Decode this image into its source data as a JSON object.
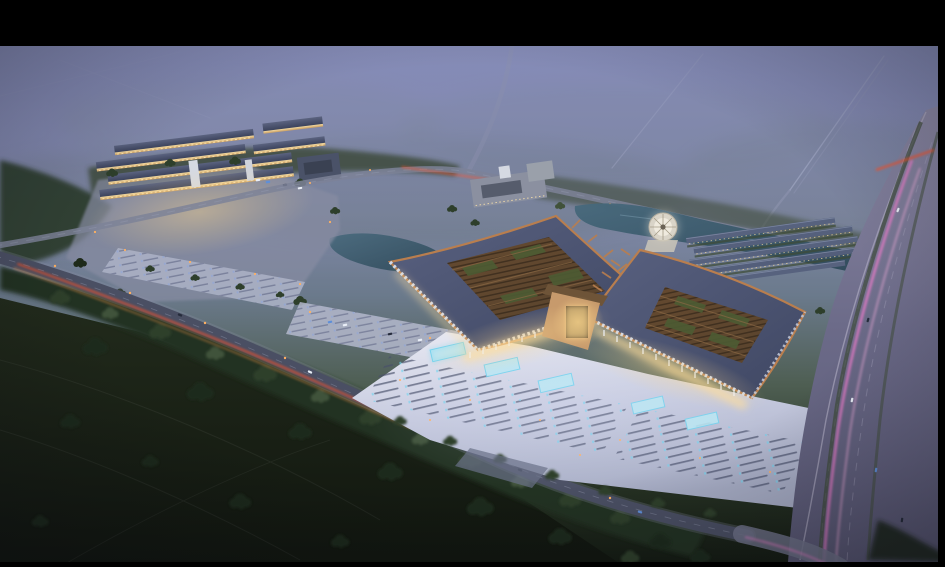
{
  "image": {
    "type": "architectural-aerial-rendering",
    "title": "Aerial dusk rendering of a traditional-style market and exhibition complex",
    "description": "Photorealistic bird's-eye 3D rendering at dusk: two large Chinese-style halls with upswept copper-edged roofs and open lattice courtyards front a brightly lit plaza with cyan reflecting pools and stall rows; a secondary warehouse market complex sits to the west; a pond with a circular fountain plaza and rows of dormitory buildings lie to the north-east; a multi-lane highway with pink light trails runs along the right edge; a diagonal road with red tail-light trails crosses dark fields and forest in the foreground; the frame is letterboxed with black bars.",
    "time_of_day": "dusk",
    "letterbox": "black bars: top, thin right and bottom edges"
  },
  "scene": {
    "features": [
      {
        "name": "sky-haze",
        "label": "lavender dusk haze over distant fields"
      },
      {
        "name": "far-roads",
        "label": "hazy diagonal country roads, top right"
      },
      {
        "name": "forest-bands",
        "label": "dark tree belts along roads and site edges"
      },
      {
        "name": "dark-field",
        "label": "unlit farmland, bottom left"
      },
      {
        "name": "left-complex",
        "label": "western market complex with lit warehouse rows and parking"
      },
      {
        "name": "main-complex",
        "label": "two grand halls with lattice courtyard roofs and central gate"
      },
      {
        "name": "plaza",
        "label": "illuminated forecourt with pools, stalls and lamps"
      },
      {
        "name": "pond",
        "label": "canal pond behind the halls"
      },
      {
        "name": "fountain-plaza",
        "label": "round white fountain terrace"
      },
      {
        "name": "dorm-rows",
        "label": "parallel rows of small buildings, north-east"
      },
      {
        "name": "highway",
        "label": "wide highway with pink light trails, right edge"
      },
      {
        "name": "front-road",
        "label": "diagonal arterial road with red tail-light trails"
      },
      {
        "name": "letterbox-bars",
        "label": "black letterbox frame"
      }
    ]
  },
  "colors": {
    "frame": "#000000",
    "sky_top": "#6d76b2",
    "sky_mid": "#7d84ae",
    "haze": "#8a90b8",
    "ground_far": "#66775f",
    "field": "#10150e",
    "forest": "#243020",
    "tree_dark": "#1e2a1a",
    "tree_mid": "#2e3f2b",
    "tree_lit": "#41523a",
    "road_far": "#a9aec4",
    "road_mid": "#7d8398",
    "road_dark": "#4a4f63",
    "trail_red": "#ff5226",
    "trail_orange": "#ff9a4a",
    "lamp": "#ffb061",
    "highway": "#6b6a88",
    "highway_lane": "#a8a5be",
    "trail_pink": "#ff7fd4",
    "plaza": "#c6cadf",
    "plaza_bright": "#e9eaf3",
    "stall": "#49506a",
    "pool": "#6fd2ee",
    "roof": "#3f4763",
    "roof_light": "#596180",
    "copper": "#b97e4e",
    "lattice": "#5a442e",
    "court_green": "#4d5c33",
    "wall_warm": "#e7c488",
    "glow_warm": "#ffd98f",
    "water": "#2c4656",
    "water_light": "#47697c",
    "white_bldg": "#d5d9e2",
    "eave": "#d3d9e8",
    "car_white": "#e9eef7",
    "car_blue": "#5f8fd8"
  }
}
